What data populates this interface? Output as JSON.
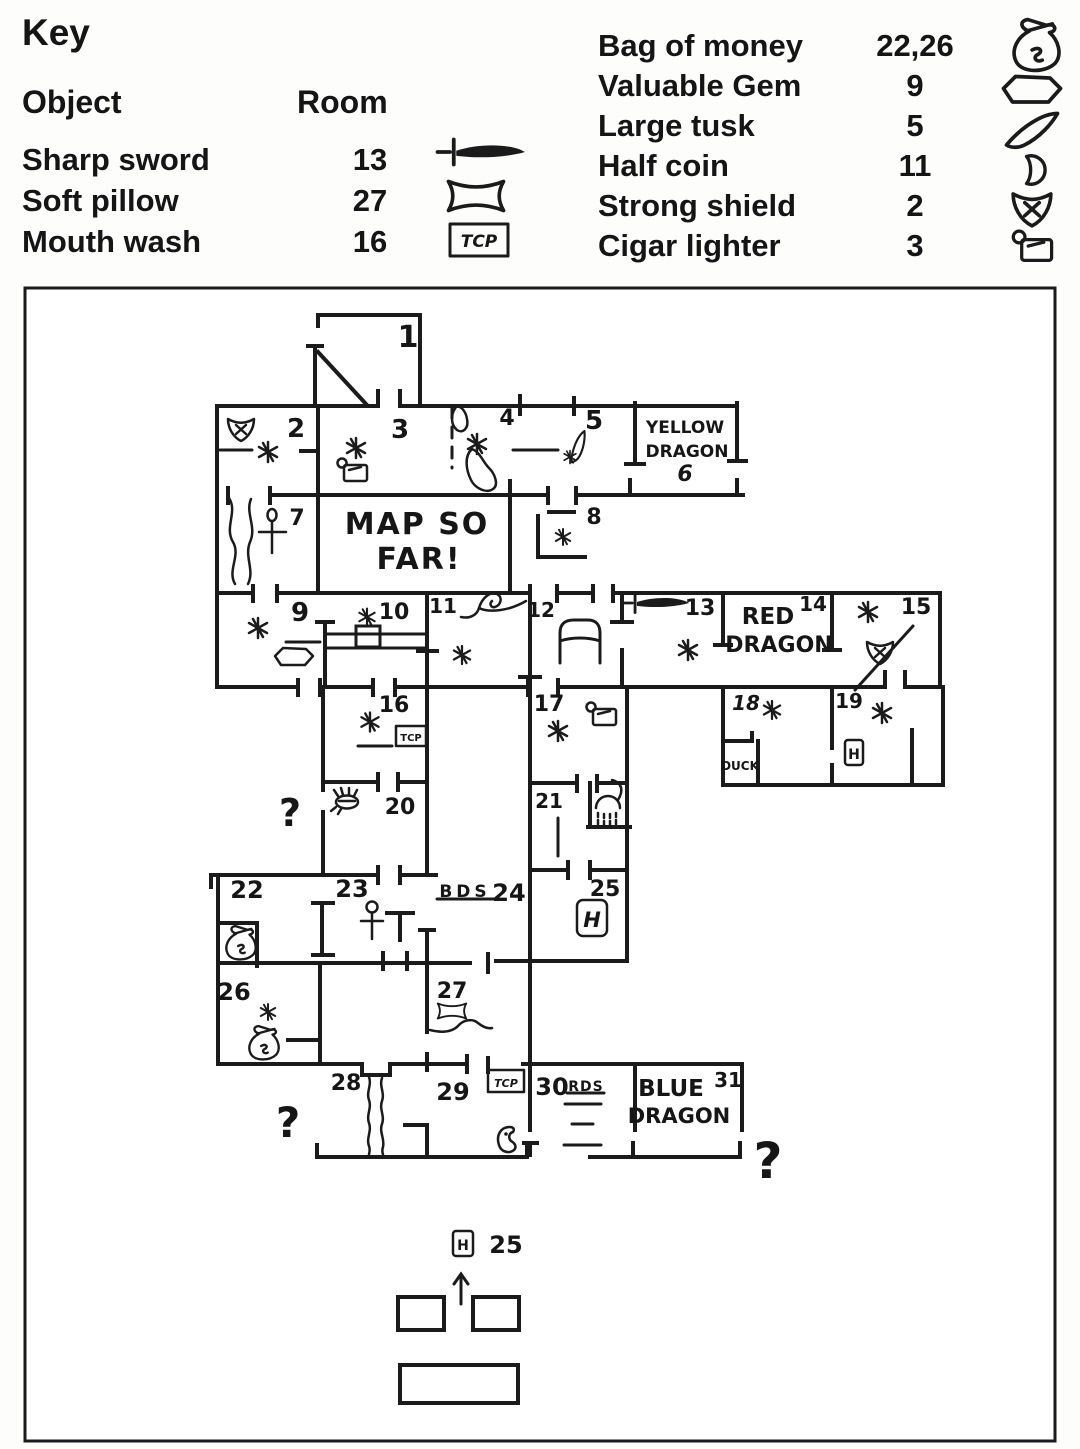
{
  "colors": {
    "ink": "#1b1b1b",
    "paper": "#fdfdfc"
  },
  "key": {
    "title": "Key",
    "col_object": "Object",
    "col_room": "Room",
    "left_items": [
      {
        "object": "Sharp sword",
        "room": "13",
        "icon": "sword-icon"
      },
      {
        "object": "Soft pillow",
        "room": "27",
        "icon": "pillow-icon"
      },
      {
        "object": "Mouth wash",
        "room": "16",
        "icon": "tcp-box-icon"
      }
    ],
    "right_items": [
      {
        "object": "Bag of money",
        "room": "22,26",
        "icon": "money-bag-icon"
      },
      {
        "object": "Valuable Gem",
        "room": "9",
        "icon": "gem-icon"
      },
      {
        "object": "Large tusk",
        "room": "5",
        "icon": "tusk-icon"
      },
      {
        "object": "Half coin",
        "room": "11",
        "icon": "half-coin-icon"
      },
      {
        "object": "Strong shield",
        "room": "2",
        "icon": "shield-icon"
      },
      {
        "object": "Cigar lighter",
        "room": "3",
        "icon": "lighter-icon"
      }
    ]
  },
  "map": {
    "rooms": {
      "r1": "1",
      "r2": "2",
      "r3": "3",
      "r4": "4",
      "r5": "5",
      "r6": "6",
      "r7": "7",
      "r8": "8",
      "r9": "9",
      "r10": "10",
      "r11": "11",
      "r12": "12",
      "r13": "13",
      "r14": "14",
      "r15": "15",
      "r16": "16",
      "r17": "17",
      "r18": "18",
      "r19": "19",
      "r20": "20",
      "r21": "21",
      "r22": "22",
      "r23": "23",
      "r24": "24",
      "r25": "25",
      "r26": "26",
      "r27": "27",
      "r28": "28",
      "r29": "29",
      "r30": "30",
      "r31": "31"
    },
    "labels": {
      "title_1": "MAP SO",
      "title_2": "FAR!",
      "yellow_1": "YELLOW",
      "yellow_2": "DRAGON",
      "red_1": "RED",
      "red_2": "DRAGON",
      "blue_1": "BLUE",
      "blue_2": "DRAGON",
      "duck": "DUCK",
      "bds": "BDS",
      "rds": "RDS",
      "tcp": "TCP",
      "h": "H",
      "question": "?"
    }
  }
}
